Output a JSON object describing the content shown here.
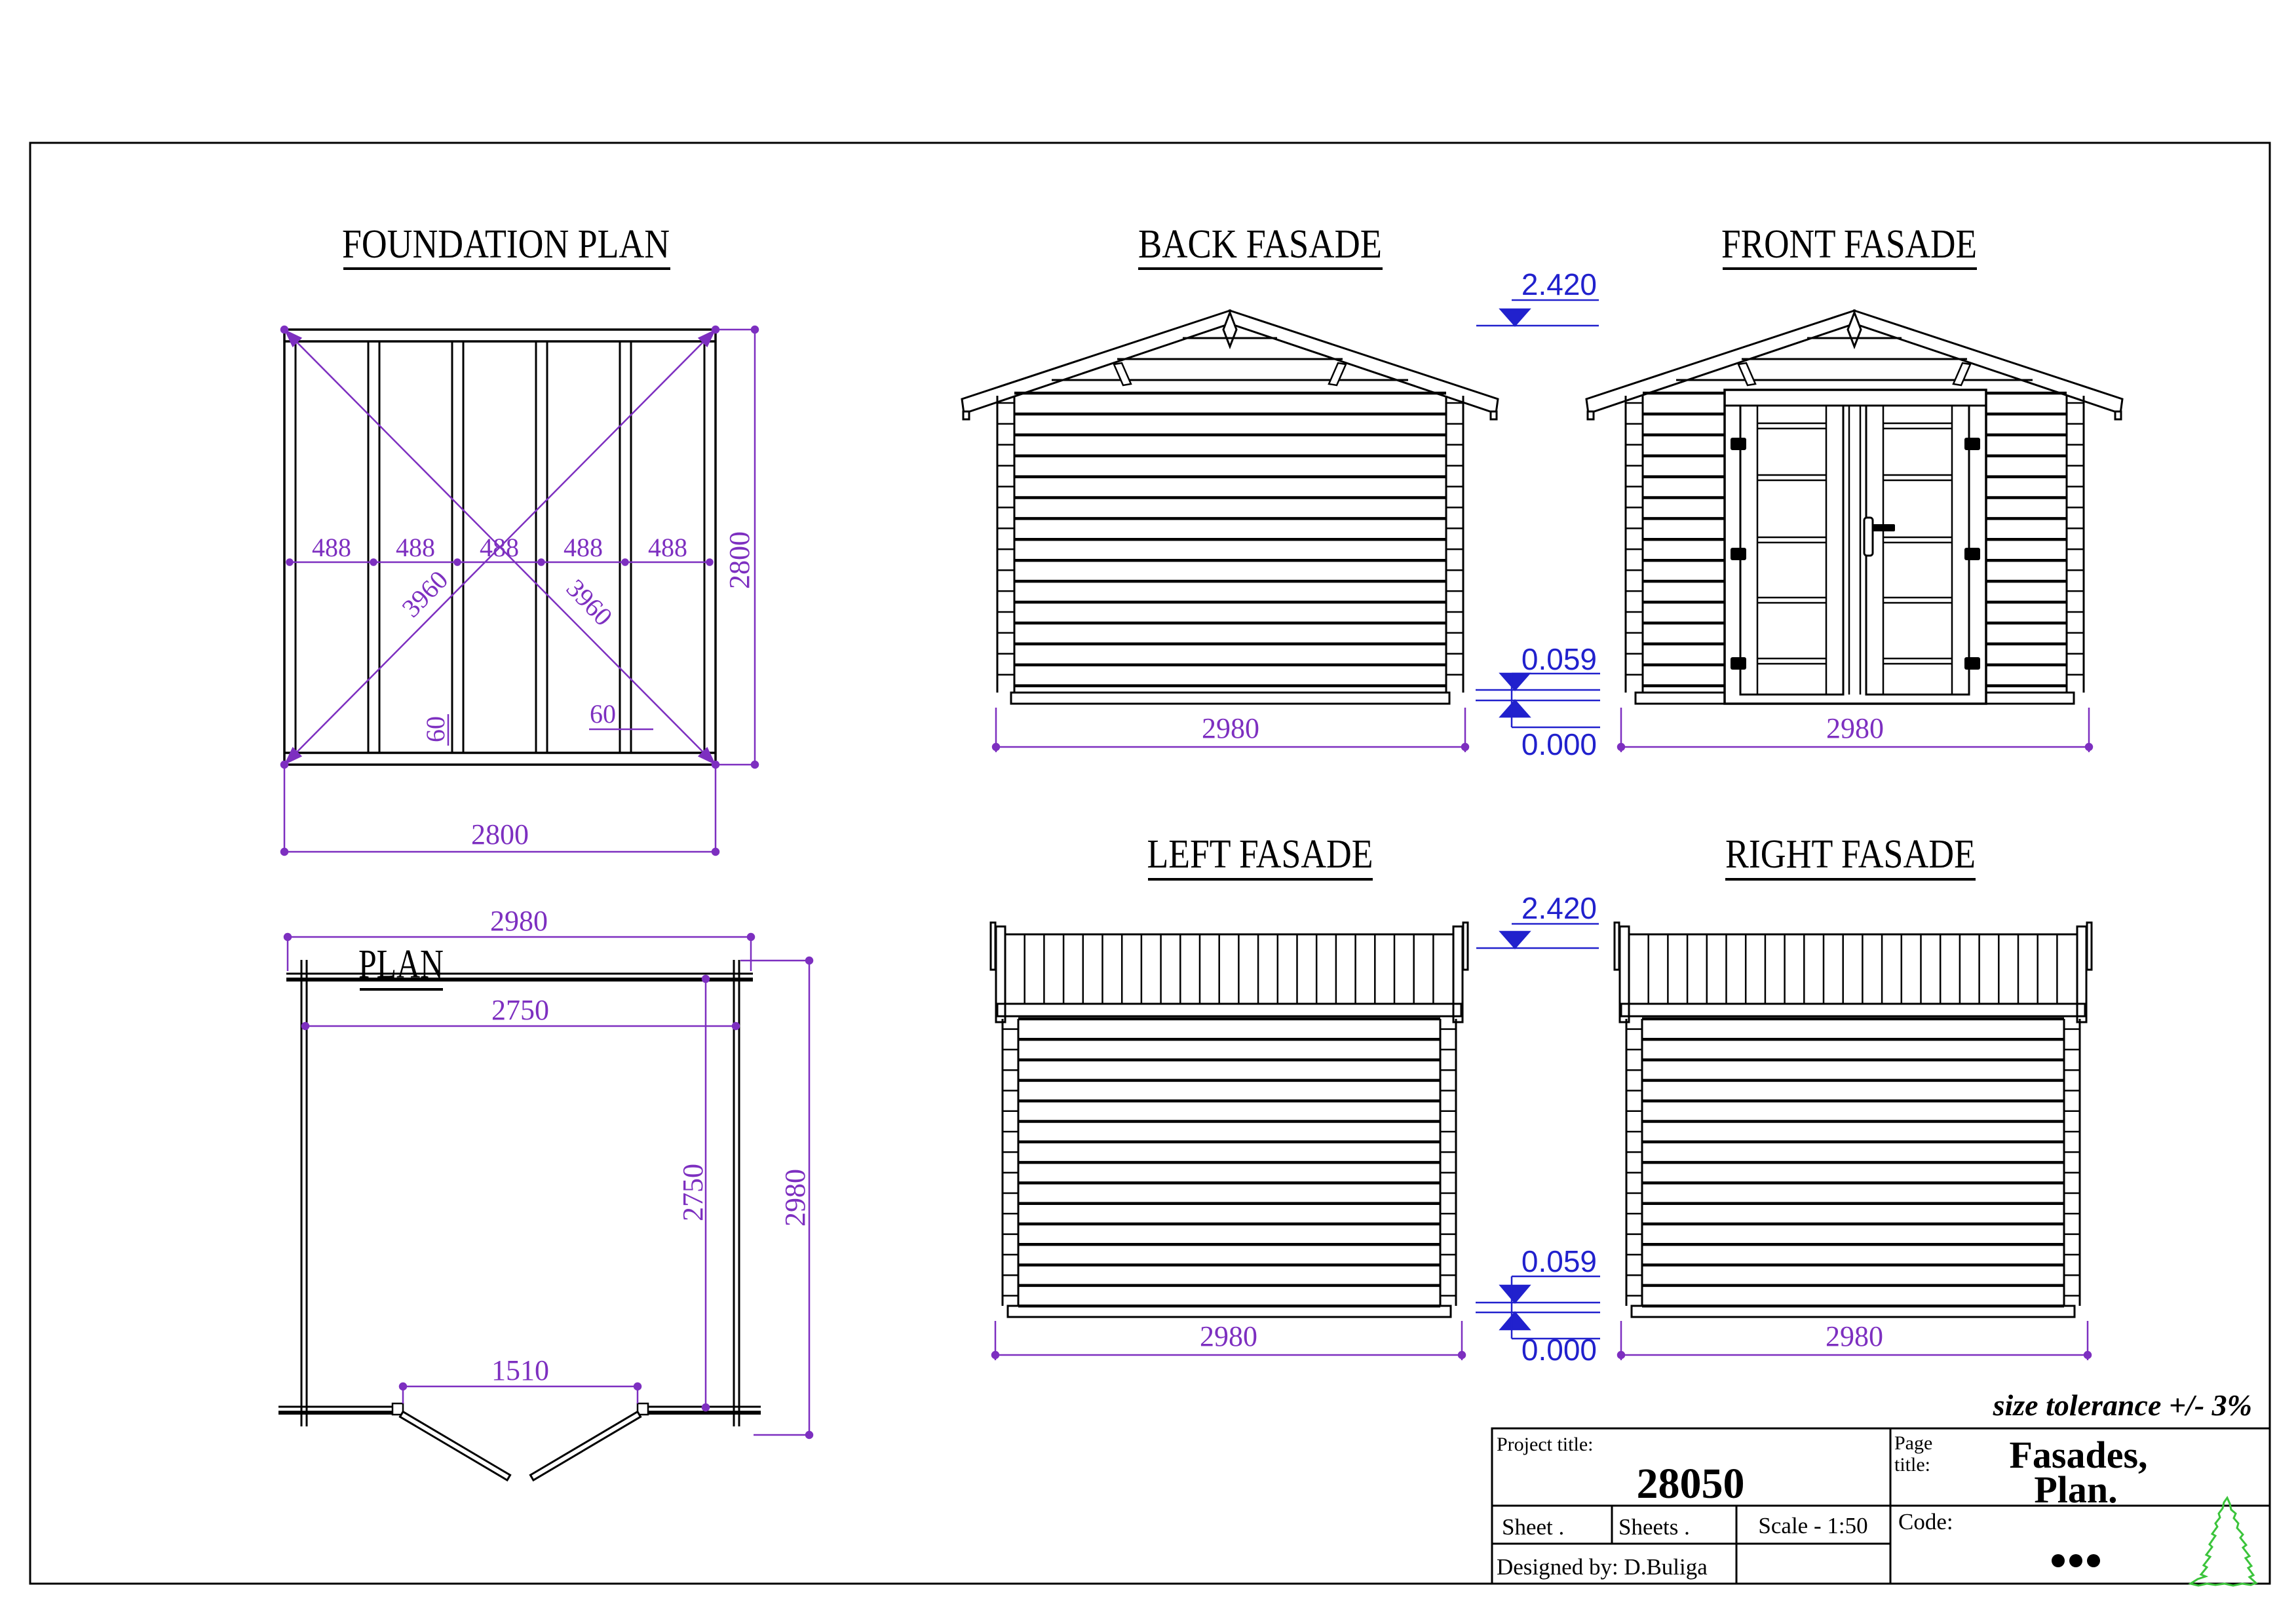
{
  "colors": {
    "line": "#000000",
    "dimension": "#7d2fc0",
    "elevation": "#2121cd",
    "tree": "#3bc43b"
  },
  "foundation": {
    "title": "FOUNDATION PLAN",
    "bay_labels": [
      "488",
      "488",
      "488",
      "488",
      "488"
    ],
    "diagonal_labels": [
      "3960",
      "3960"
    ],
    "joist_labels": [
      "60",
      "60"
    ],
    "side_dim": "2800",
    "bottom_dim": "2800"
  },
  "plan": {
    "title": "PLAN",
    "outer_width_dim": "2980",
    "inner_width_dim": "2750",
    "door_opening_dim": "1510",
    "inner_depth_dim": "2750",
    "outer_depth_dim": "2980"
  },
  "fasades": {
    "back": {
      "title": "BACK FASADE",
      "width_dim": "2980"
    },
    "front": {
      "title": "FRONT FASADE",
      "width_dim": "2980"
    },
    "left": {
      "title": "LEFT FASADE",
      "width_dim": "2980"
    },
    "right": {
      "title": "RIGHT FASADE",
      "width_dim": "2980"
    }
  },
  "levels": {
    "eave": "2.420",
    "plinth": "0.059",
    "ground": "0.000"
  },
  "titleblock": {
    "tolerance_note": "size tolerance +/- 3%",
    "project_label": "Project title:",
    "project_number": "28050",
    "page_label_line1": "Page",
    "page_label_line2": "title:",
    "page_title_line1": "Fasades,",
    "page_title_line2": "Plan.",
    "sheet_label": "Sheet .",
    "sheets_label": "Sheets .",
    "scale_label": "Scale - 1:50",
    "code_label": "Code:",
    "designed_by": "Designed by: D.Buliga"
  }
}
